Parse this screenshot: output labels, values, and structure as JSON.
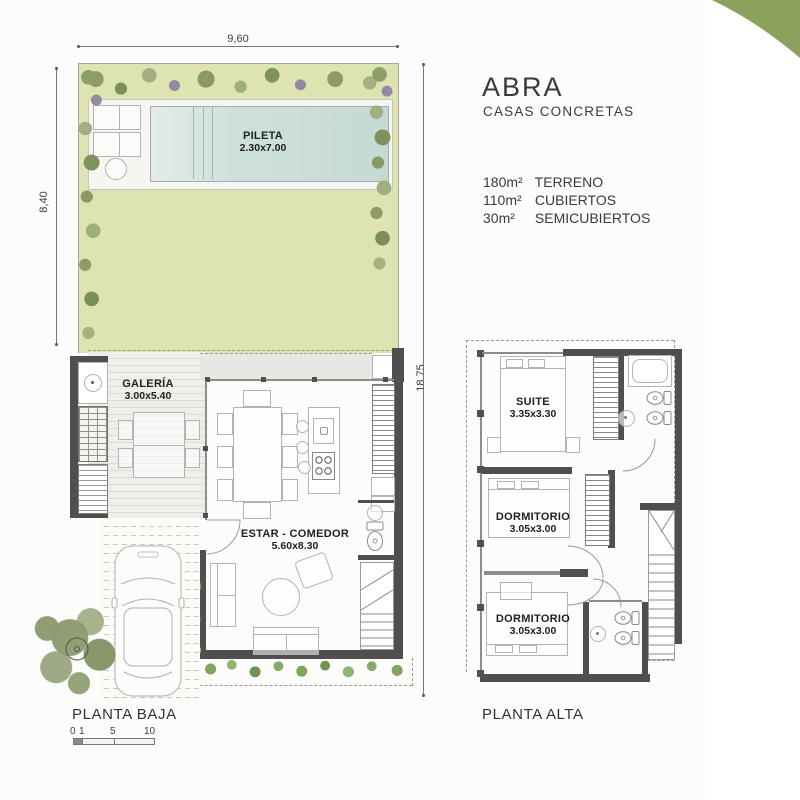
{
  "brand": {
    "name": "ABRA",
    "subtitle": "CASAS CONCRETAS"
  },
  "areas": [
    {
      "value": "180m²",
      "label": "TERRENO"
    },
    {
      "value": "110m²",
      "label": "CUBIERTOS"
    },
    {
      "value": "30m²",
      "label": "SEMICUBIERTOS"
    }
  ],
  "ground_floor": {
    "label": "PLANTA BAJA",
    "dimensions": {
      "width": "9,60",
      "garden_depth": "8,40",
      "total_depth": "18.75"
    },
    "rooms": [
      {
        "name": "PILETA",
        "size": "2.30x7.00"
      },
      {
        "name": "GALERÍA",
        "size": "3.00x5.40"
      },
      {
        "name": "ESTAR - COMEDOR",
        "size": "5.60x8.30"
      }
    ],
    "scale_ticks": [
      "0",
      "1",
      "5",
      "10"
    ]
  },
  "upper_floor": {
    "label": "PLANTA ALTA",
    "rooms": [
      {
        "name": "SUITE",
        "size": "3.35x3.30"
      },
      {
        "name": "DORMITORIO",
        "size": "3.05x3.00"
      },
      {
        "name": "DORMITORIO",
        "size": "3.05x3.00"
      }
    ]
  },
  "colors": {
    "corner_accent": "#8ba25d",
    "garden": "#dee4b1",
    "pool": "#c9dcd7",
    "deck_stripe": "#dcdbd5",
    "wall": "#4f4f4f",
    "foliage": "#8e9e6a"
  }
}
